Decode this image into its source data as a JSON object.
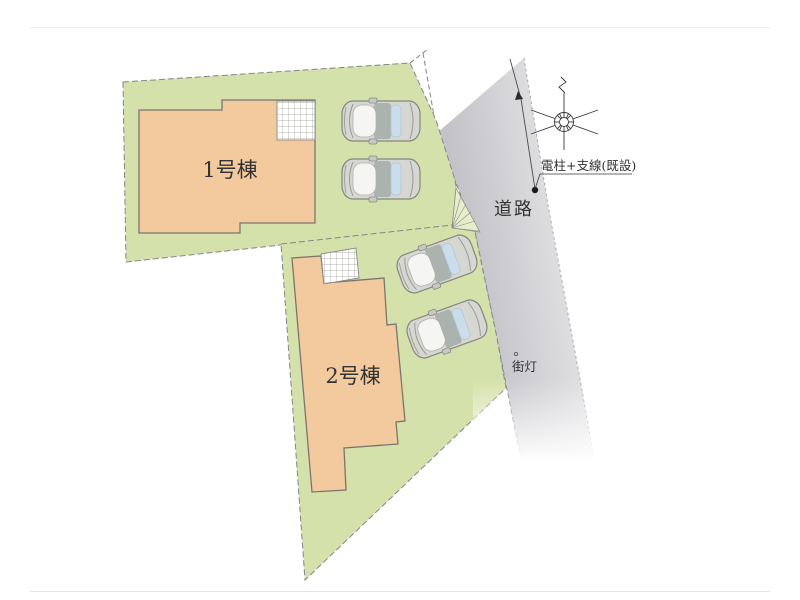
{
  "plan": {
    "labels": {
      "building1": "1号棟",
      "building2": "2号棟",
      "road": "道路",
      "utility_pole": "電柱+支線(既設)",
      "street_light": "街灯"
    },
    "colors": {
      "plot_green": "#d5e1aa",
      "wedge_green": "#e6edcb",
      "building_fill": "#f3c99e",
      "building_stroke": "#7a766f",
      "hatch_fill": "#ffffff",
      "road_dark": "#c2c2c7",
      "road_mid": "#dcdcdf",
      "road_light": "#efeff1",
      "boundary_line": "#85858a",
      "text": "#333333",
      "car_body": "#d6d7d2",
      "car_outline": "#85867f",
      "car_roof": "#aab3ad",
      "car_rear_window": "#cadded",
      "car_windshield": "#f5f6f3"
    },
    "icons": {
      "car": "car-top-view-icon",
      "pole": "utility-pole-icon",
      "guy_wire": "guy-wire-arrow-icon",
      "street_light": "street-light-icon"
    }
  }
}
